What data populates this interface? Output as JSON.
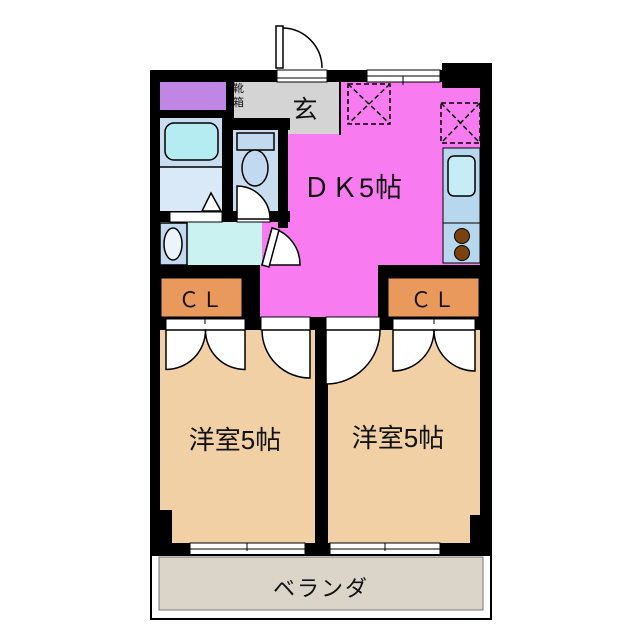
{
  "plan_type": "apartment-floorplan-2DK",
  "labels": {
    "dk": "ＤＫ5帖",
    "room_left": "洋室5帖",
    "room_right": "洋室5帖",
    "closet_left": "ＣＬ",
    "closet_right": "ＣＬ",
    "entrance": "玄",
    "shoe_box": "靴箱",
    "veranda": "ベランダ"
  },
  "colors": {
    "wall": "#000000",
    "dk_pink": "#f87cef",
    "room_tan": "#f1d0a5",
    "closet_orange": "#e9995b",
    "genkan_gray": "#d4d4d4",
    "storage_purple": "#bf86e3",
    "bathroom_blue": "#c9ddf1",
    "bathroom_blue_light": "#d9e9f8",
    "washroom_cyan": "#c9f2f0",
    "fixture_blue": "#c3d9f0",
    "bathtub_cyan": "#b5ecf2",
    "kitchen_counter": "#b7d7ee",
    "kitchen_sink": "#c6ecf5",
    "burner_brown": "#7b4210",
    "basin_oval": "#ecf4fa",
    "veranda_gray": "#dbd4c8"
  }
}
